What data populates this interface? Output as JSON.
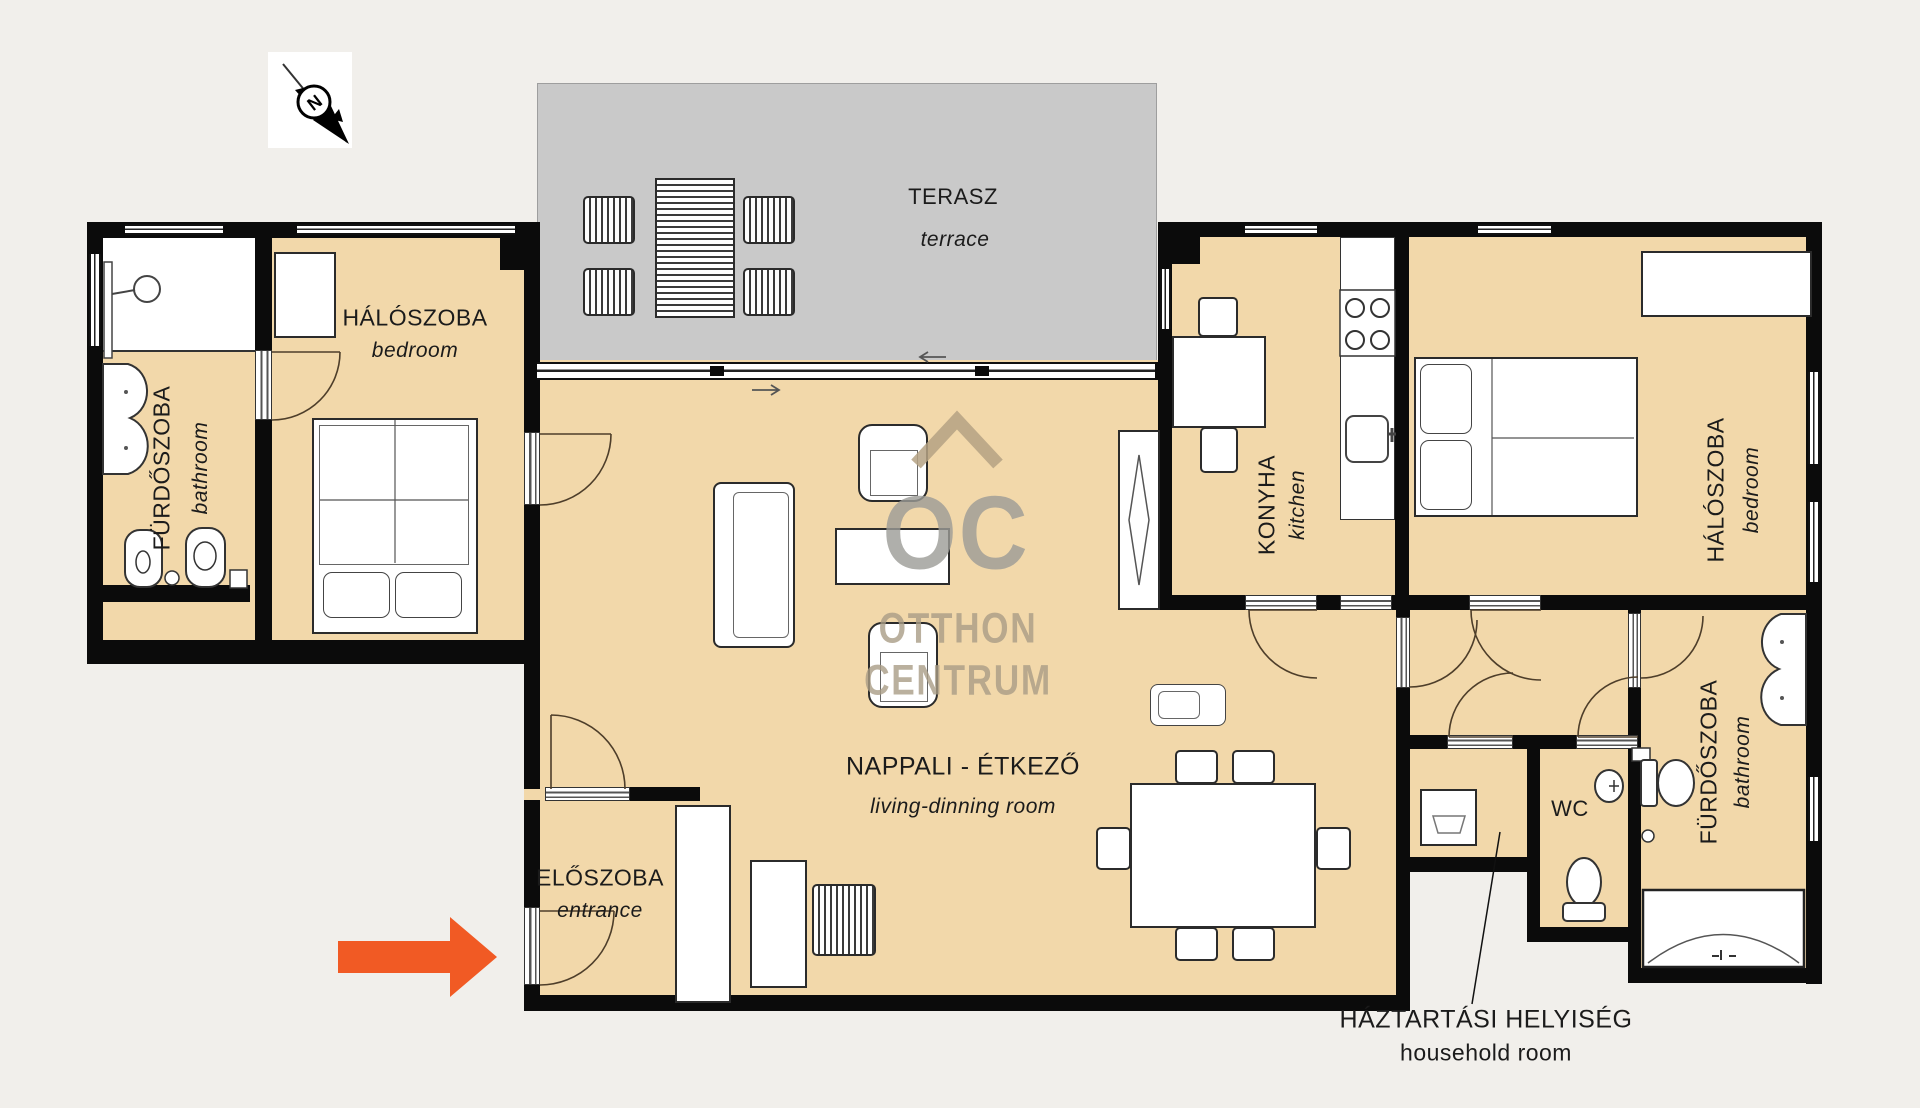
{
  "compass": {
    "north_label": "N"
  },
  "watermark": {
    "monogram": "OC",
    "word1": "OTTHON",
    "word2": "CENTRUM"
  },
  "rooms": {
    "terrace": {
      "hu": "TERASZ",
      "en": "terrace"
    },
    "bathroom_left": {
      "hu": "FÜRDŐSZOBA",
      "en": "bathroom"
    },
    "bedroom_left": {
      "hu": "HÁLÓSZOBA",
      "en": "bedroom"
    },
    "living_dining": {
      "hu": "NAPPALI - ÉTKEZŐ",
      "en": "living-dinning room"
    },
    "entrance": {
      "hu": "ELŐSZOBA",
      "en": "entrance"
    },
    "kitchen": {
      "hu": "KONYHA",
      "en": "kitchen"
    },
    "bedroom_right": {
      "hu": "HÁLÓSZOBA",
      "en": "bedroom"
    },
    "bathroom_right": {
      "hu": "FÜRDŐSZOBA",
      "en": "bathroom"
    },
    "wc": {
      "hu": "WC"
    },
    "household": {
      "hu": "HÁZTARTÁSI HELYISÉG",
      "en": "household room"
    }
  },
  "colors": {
    "background": "#f1efeb",
    "room_fill": "#f2d8aa",
    "terrace_fill": "#c9c9c9",
    "wall": "#0b0b0b",
    "watermark": "#a89a82",
    "entrance_arrow": "#f15a24"
  }
}
